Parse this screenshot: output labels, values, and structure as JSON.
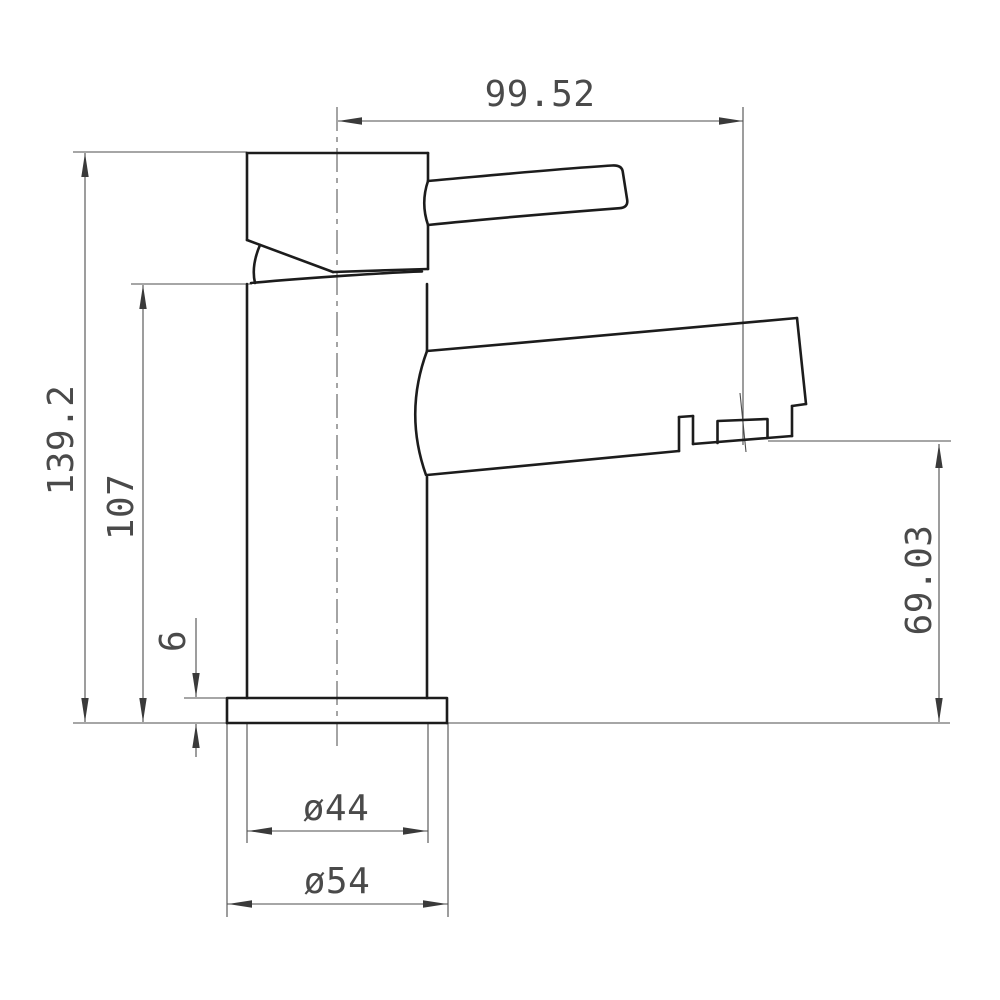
{
  "drawing": {
    "type": "technical-orthographic-side-view",
    "subject": "single-lever basin mixer tap",
    "units_shown": false
  },
  "style": {
    "outline_color": "#1c1c1c",
    "dimension_line_color": "#4d4d4d",
    "arrow_color": "#3a3a3a",
    "text_color": "#4a4a4a",
    "background": "#ffffff"
  },
  "dimensions": {
    "spout_reach": "99.52",
    "overall_height": "139.2",
    "body_height": "107",
    "base_plate_thickness": "6",
    "outlet_height": "69.03",
    "body_diameter": "ø44",
    "base_diameter": "ø54"
  }
}
